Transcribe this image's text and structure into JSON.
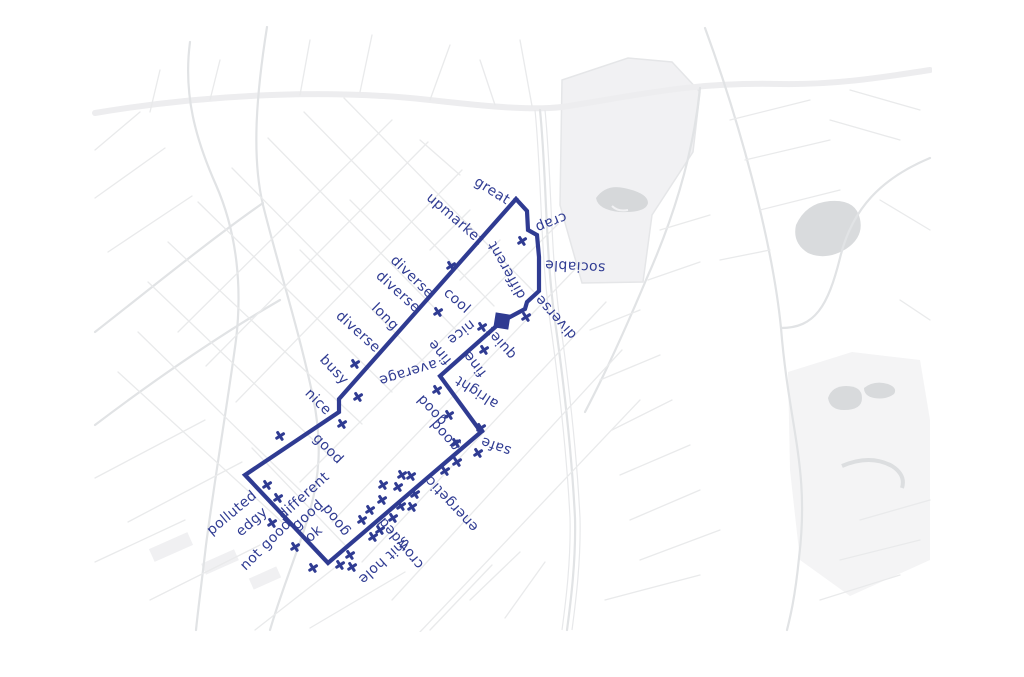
{
  "title": "neighbourhood sentiment walk map",
  "colors": {
    "route": "#2f3b92",
    "background": "#ffffff",
    "street_minor": "#e9eaeb",
    "street_major": "#e1e3e5",
    "street_band": "#ededef",
    "railway": "#e7e8ea",
    "park_fill": "#f1f1f3",
    "park_fill_light": "#f4f4f5",
    "pond_fill": "#d6d8da",
    "blob_fill": "#d9dbdd"
  },
  "route": {
    "stroke_width": 4.2,
    "points": [
      [
        516,
        199
      ],
      [
        527,
        211
      ],
      [
        528,
        230
      ],
      [
        537,
        235
      ],
      [
        539,
        257
      ],
      [
        539,
        291
      ],
      [
        527,
        302
      ],
      [
        525,
        309
      ],
      [
        510,
        317
      ],
      [
        502,
        321
      ],
      [
        440,
        376
      ],
      [
        481,
        432
      ],
      [
        328,
        563
      ],
      [
        245,
        475
      ],
      [
        339,
        412
      ],
      [
        339,
        399
      ],
      [
        516,
        199
      ]
    ]
  },
  "start_marker": {
    "x": 502,
    "y": 321,
    "size": 15,
    "rotation": 9,
    "shape": "square"
  },
  "labels": [
    {
      "text": "great",
      "x": 492,
      "y": 191,
      "rotation": 32
    },
    {
      "text": "upmarket",
      "x": 455,
      "y": 219,
      "rotation": 41
    },
    {
      "text": "crap",
      "x": 551,
      "y": 222,
      "rotation": 158
    },
    {
      "text": "sociable",
      "x": 575,
      "y": 266,
      "rotation": 183
    },
    {
      "text": "different",
      "x": 507,
      "y": 270,
      "rotation": 241
    },
    {
      "text": "diverse",
      "x": 556,
      "y": 317,
      "rotation": 228
    },
    {
      "text": "diverse",
      "x": 412,
      "y": 277,
      "rotation": 44
    },
    {
      "text": "diverse",
      "x": 398,
      "y": 292,
      "rotation": 42
    },
    {
      "text": "cool",
      "x": 457,
      "y": 301,
      "rotation": 42
    },
    {
      "text": "long",
      "x": 385,
      "y": 317,
      "rotation": 45
    },
    {
      "text": "diverse",
      "x": 358,
      "y": 332,
      "rotation": 42
    },
    {
      "text": "busy",
      "x": 334,
      "y": 370,
      "rotation": 47
    },
    {
      "text": "nice",
      "x": 318,
      "y": 402,
      "rotation": 45
    },
    {
      "text": "good",
      "x": 328,
      "y": 449,
      "rotation": 45
    },
    {
      "text": "average",
      "x": 408,
      "y": 372,
      "rotation": 163
    },
    {
      "text": "nice",
      "x": 461,
      "y": 332,
      "rotation": 142
    },
    {
      "text": "fine",
      "x": 440,
      "y": 352,
      "rotation": 230
    },
    {
      "text": "fine",
      "x": 475,
      "y": 364,
      "rotation": 232
    },
    {
      "text": "quiet",
      "x": 501,
      "y": 343,
      "rotation": 228
    },
    {
      "text": "alright",
      "x": 477,
      "y": 392,
      "rotation": 213
    },
    {
      "text": "good",
      "x": 432,
      "y": 410,
      "rotation": 227
    },
    {
      "text": "good",
      "x": 445,
      "y": 435,
      "rotation": 228
    },
    {
      "text": "safe",
      "x": 496,
      "y": 446,
      "rotation": 200
    },
    {
      "text": "energetic",
      "x": 452,
      "y": 504,
      "rotation": 227
    },
    {
      "text": "polluted",
      "x": 232,
      "y": 513,
      "rotation": -40
    },
    {
      "text": "edgy",
      "x": 252,
      "y": 522,
      "rotation": -41
    },
    {
      "text": "different",
      "x": 304,
      "y": 496,
      "rotation": -42
    },
    {
      "text": "good",
      "x": 308,
      "y": 515,
      "rotation": -42
    },
    {
      "text": "ok",
      "x": 314,
      "y": 534,
      "rotation": -40
    },
    {
      "text": "not good",
      "x": 266,
      "y": 545,
      "rotation": -45
    },
    {
      "text": "good",
      "x": 336,
      "y": 520,
      "rotation": 232
    },
    {
      "text": "shit hole",
      "x": 384,
      "y": 560,
      "rotation": 138
    },
    {
      "text": "crowded",
      "x": 401,
      "y": 543,
      "rotation": 230
    }
  ],
  "x_marks": [
    [
      522,
      241
    ],
    [
      451,
      266
    ],
    [
      438,
      312
    ],
    [
      526,
      317
    ],
    [
      482,
      327
    ],
    [
      484,
      350
    ],
    [
      355,
      364
    ],
    [
      358,
      397
    ],
    [
      342,
      424
    ],
    [
      280,
      436
    ],
    [
      437,
      390
    ],
    [
      449,
      415
    ],
    [
      481,
      428
    ],
    [
      456,
      443
    ],
    [
      478,
      453
    ],
    [
      457,
      462
    ],
    [
      445,
      471
    ],
    [
      402,
      475
    ],
    [
      411,
      476
    ],
    [
      398,
      487
    ],
    [
      415,
      494
    ],
    [
      401,
      506
    ],
    [
      412,
      507
    ],
    [
      393,
      518
    ],
    [
      380,
      530
    ],
    [
      373,
      537
    ],
    [
      362,
      520
    ],
    [
      370,
      510
    ],
    [
      382,
      500
    ],
    [
      383,
      485
    ],
    [
      267,
      485
    ],
    [
      278,
      498
    ],
    [
      272,
      523
    ],
    [
      295,
      547
    ],
    [
      313,
      568
    ],
    [
      340,
      565
    ],
    [
      352,
      567
    ],
    [
      350,
      555
    ]
  ]
}
